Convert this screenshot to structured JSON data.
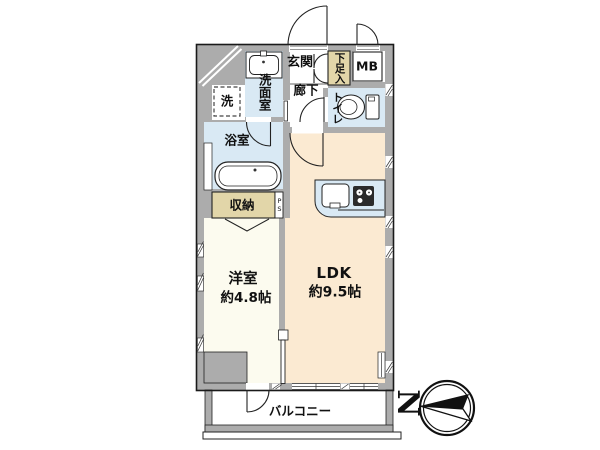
{
  "floorplan": {
    "labels": {
      "genkan": "玄関",
      "shoe_cabinet": "下足入",
      "meter_box": "MB",
      "washroom": "洗面室",
      "washing_machine": "洗",
      "hallway": "廊下",
      "toilet": "トイレ",
      "bathroom": "浴室",
      "storage": "収納",
      "pipe_space": "PS",
      "western_room_name": "洋室",
      "western_room_size": "約4.8帖",
      "ldk_name": "LDK",
      "ldk_size": "約9.5帖",
      "balcony": "バルコニー",
      "compass_north": "N"
    },
    "colors": {
      "wall_gray": "#ACACAC",
      "water_area_blue": "#D9E9F4",
      "closet_tan": "#E2D6A9",
      "ldk_peach": "#FBEAD2",
      "western_room_cream": "#FCFBEF",
      "balcony_white": "#FFFFFF",
      "line_dark": "#222222"
    }
  }
}
